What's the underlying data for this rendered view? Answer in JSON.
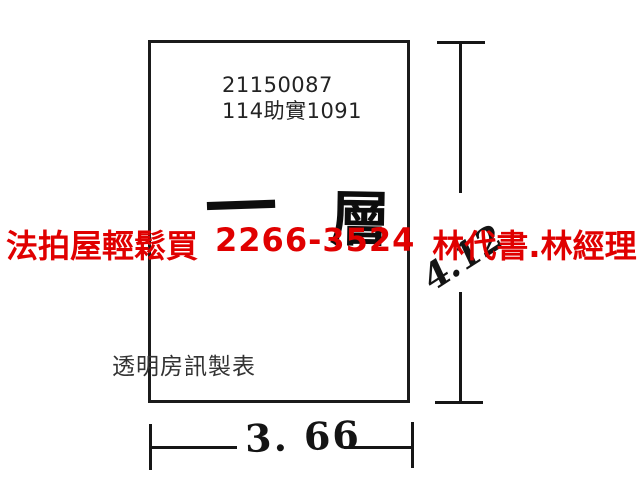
{
  "floorplan": {
    "case_number": "21150087",
    "docket_number": "114助實1091",
    "floor_label": {
      "first": "一",
      "second": "層"
    },
    "maker_credit": "透明房訊製表",
    "dimensions": {
      "height": "4.12",
      "width": "3. 66"
    }
  },
  "watermark": {
    "company": "法拍屋輕鬆買",
    "phone": "2266-3524",
    "contact": "林代書.林經理",
    "color": "#e00000"
  },
  "colors": {
    "background": "#ffffff",
    "line": "#1b1b1b",
    "text": "#232323"
  }
}
